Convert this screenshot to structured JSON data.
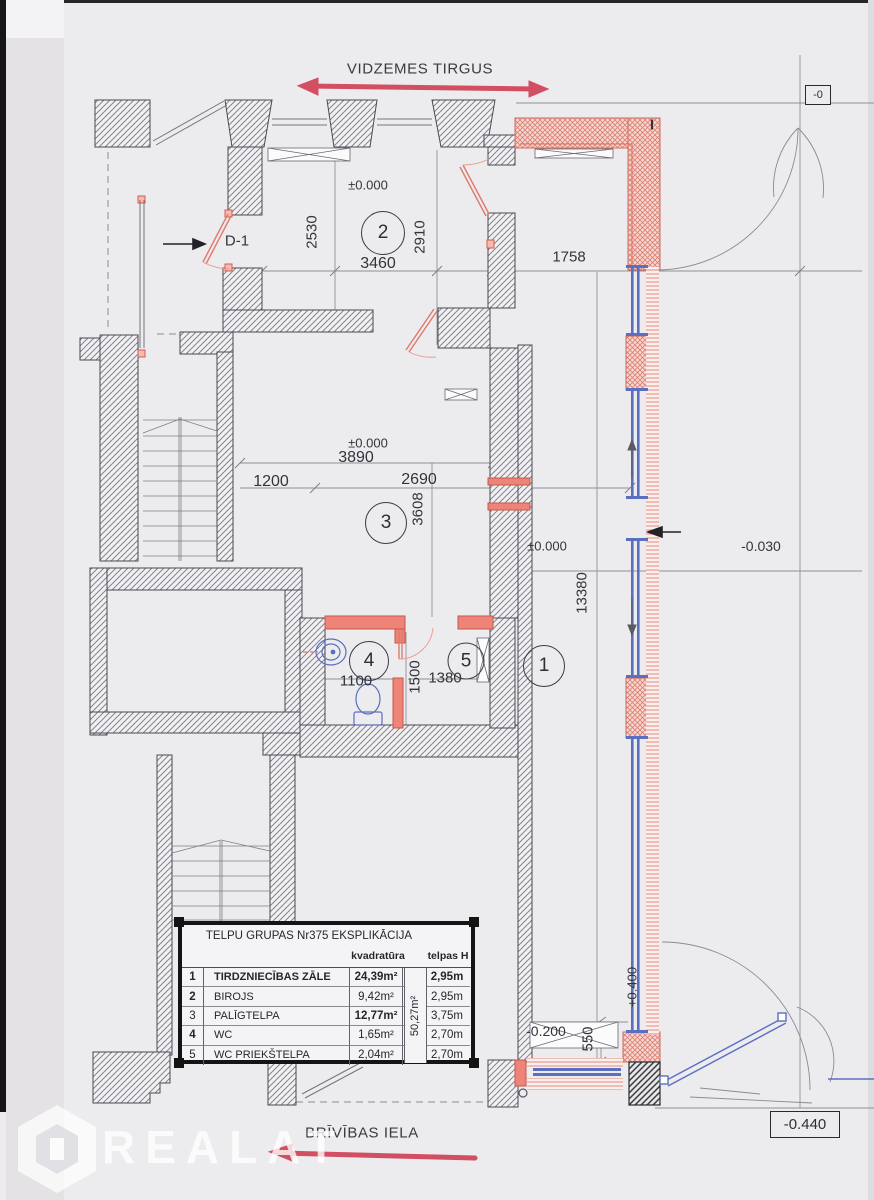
{
  "streets": {
    "top": "VIDZEMES TIRGUS",
    "bottom": "BRĪVĪBAS IELA"
  },
  "watermark": {
    "brand": "REALAT"
  },
  "plan": {
    "door_label": "D-1",
    "section_marker": "I",
    "levels": {
      "room2": "±0.000",
      "room3": "±0.000",
      "hall": "±0.000",
      "street_right": "-0.030",
      "entry_step": "+0.400",
      "rear": "-0.200",
      "corner_bottom": "-0.440",
      "corner_top": "-0"
    },
    "rooms": {
      "r1": "1",
      "r2": "2",
      "r3": "3",
      "r4": "4",
      "r5": "5"
    },
    "dims": {
      "d2530": "2530",
      "d2910": "2910",
      "d3460": "3460",
      "d1758": "1758",
      "d3890": "3890",
      "d1200": "1200",
      "d2690": "2690",
      "d3608": "3608",
      "d13380": "13380",
      "d1100": "1100",
      "d1500": "1500",
      "d1380": "1380",
      "d550": "550"
    }
  },
  "table": {
    "title": "TELPU GRUPAS Nr375  EKSPLIKĀCIJA",
    "col_area": "kvadratūra",
    "col_height": "telpas H",
    "total_area": "50,27m²",
    "rows": [
      {
        "no": "1",
        "name": "TIRDZNIECĪBAS ZĀLE",
        "area": "24,39m²",
        "height": "2,95m"
      },
      {
        "no": "2",
        "name": "BIROJS",
        "area": "9,42m²",
        "height": "2,95m"
      },
      {
        "no": "3",
        "name": "PALĪGTELPA",
        "area": "12,77m²",
        "height": "3,75m"
      },
      {
        "no": "4",
        "name": "WC",
        "area": "1,65m²",
        "height": "2,70m"
      },
      {
        "no": "5",
        "name": "WC PRIEKŠTELPA",
        "area": "2,04m²",
        "height": "2,70m"
      }
    ]
  },
  "colors": {
    "marker_red": "#cf3a4f",
    "new_wall_red": "#e8837a",
    "glazing_blue": "#5b6fc0",
    "paper": "#ecebee"
  }
}
